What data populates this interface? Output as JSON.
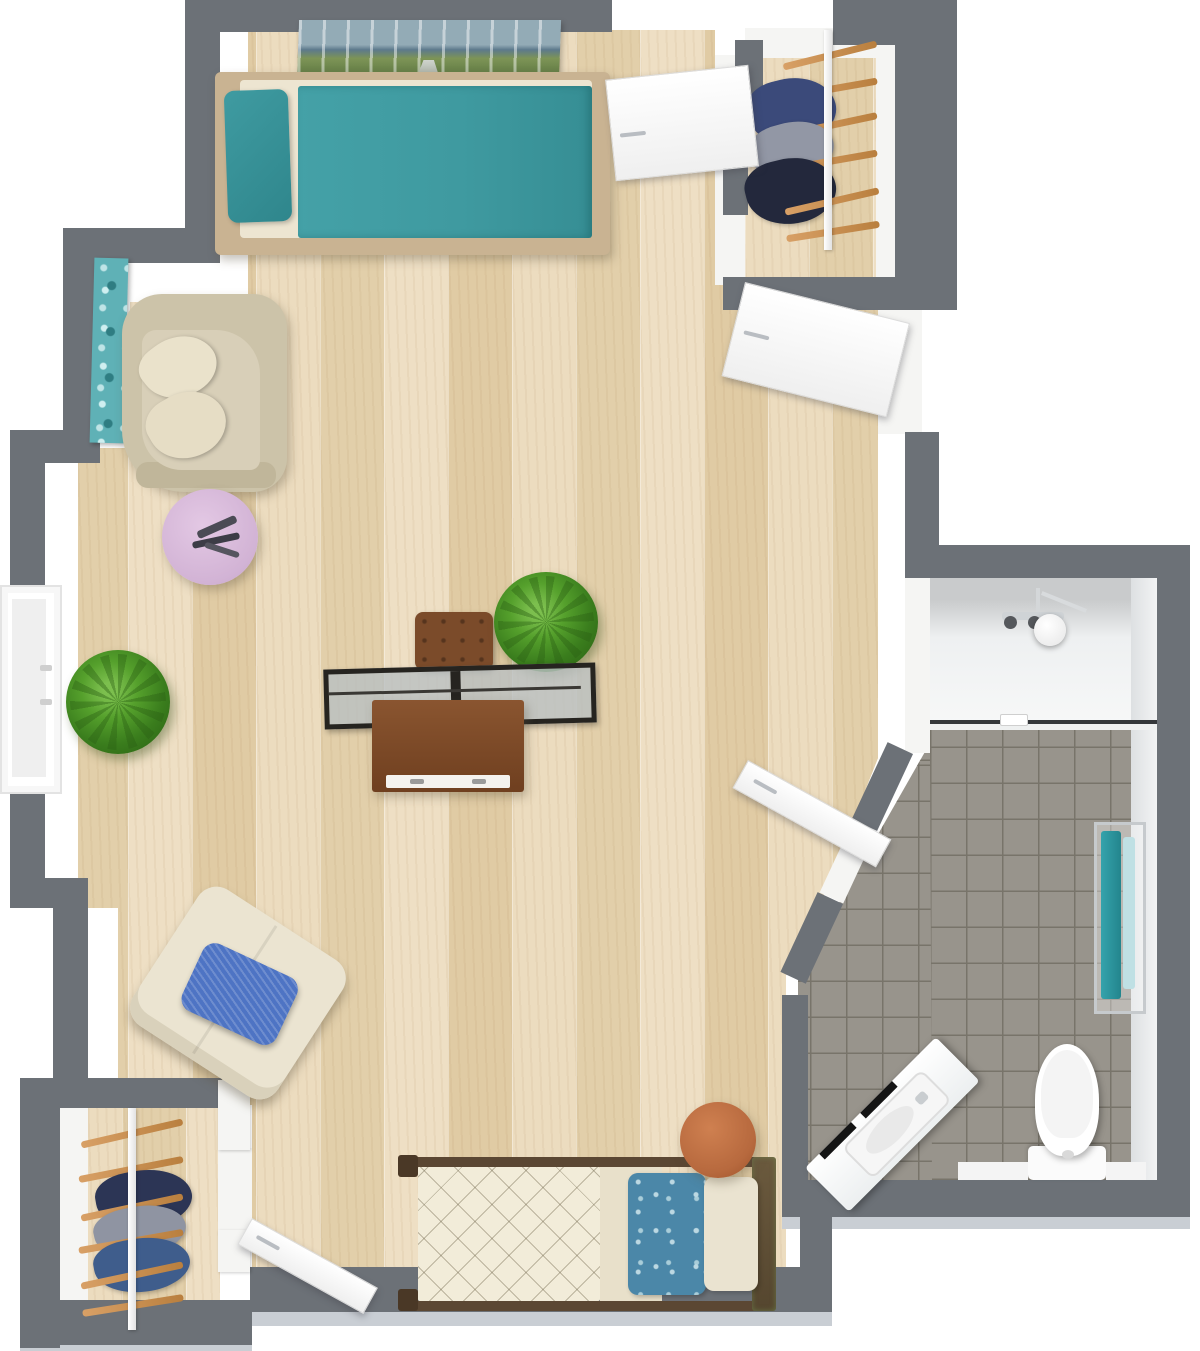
{
  "scene": {
    "kind": "3d-floor-plan-top-view",
    "description": "Rendered top-down 3D floor plan of a studio apartment with living/sleeping area, bathroom and two wardrobes",
    "rooms": [
      {
        "name": "main-living-area",
        "floor": "light-wood"
      },
      {
        "name": "bathroom",
        "floor": "gray-tile",
        "features": [
          "walk-in-shower",
          "toilet",
          "corner-sink-vanity",
          "towel-rack"
        ]
      },
      {
        "name": "wardrobe-top-right",
        "floor": "light-wood",
        "features": [
          "clothes-rack"
        ]
      },
      {
        "name": "wardrobe-bottom-left",
        "floor": "light-wood",
        "features": [
          "clothes-rack"
        ]
      }
    ]
  },
  "palette": {
    "wall": "#6c7177",
    "wall_bevel": "#c9ced4",
    "wood": "#e8d7b8",
    "tile": "#98948c",
    "teal_bedding": "#3f9aa0",
    "lavender_table": "#d9bcdb",
    "terracotta_table": "#b7693e",
    "plant_green": "#3f7d22",
    "blue_cushion": "#4e74c4",
    "floral_pillow_blue": "#4b87a8",
    "cream_upholstery": "#ece4d0",
    "desk_wood": "#7a4a28",
    "door_white": "#fafafa"
  },
  "items": [
    {
      "label": "Single bed with teal bedding"
    },
    {
      "label": "Birch forest wall art"
    },
    {
      "label": "Teal floral wall art"
    },
    {
      "label": "Curved beige loveseat with cream pillows"
    },
    {
      "label": "Round lavender side table with sculpture"
    },
    {
      "label": "Potted green plant"
    },
    {
      "label": "Desk with glass top, brown chair and drawer cabinet"
    },
    {
      "label": "Cream lounge chair with blue cushion"
    },
    {
      "label": "Single bed with quilted cover and floral pillow"
    },
    {
      "label": "Round terracotta stool"
    },
    {
      "label": "Toilet"
    },
    {
      "label": "Corner sink vanity"
    },
    {
      "label": "Walk-in shower with glass screen"
    },
    {
      "label": "Towel rack with teal towels"
    },
    {
      "label": "Clothes rack with hangers"
    },
    {
      "label": "Window"
    },
    {
      "label": "White interior door"
    }
  ]
}
